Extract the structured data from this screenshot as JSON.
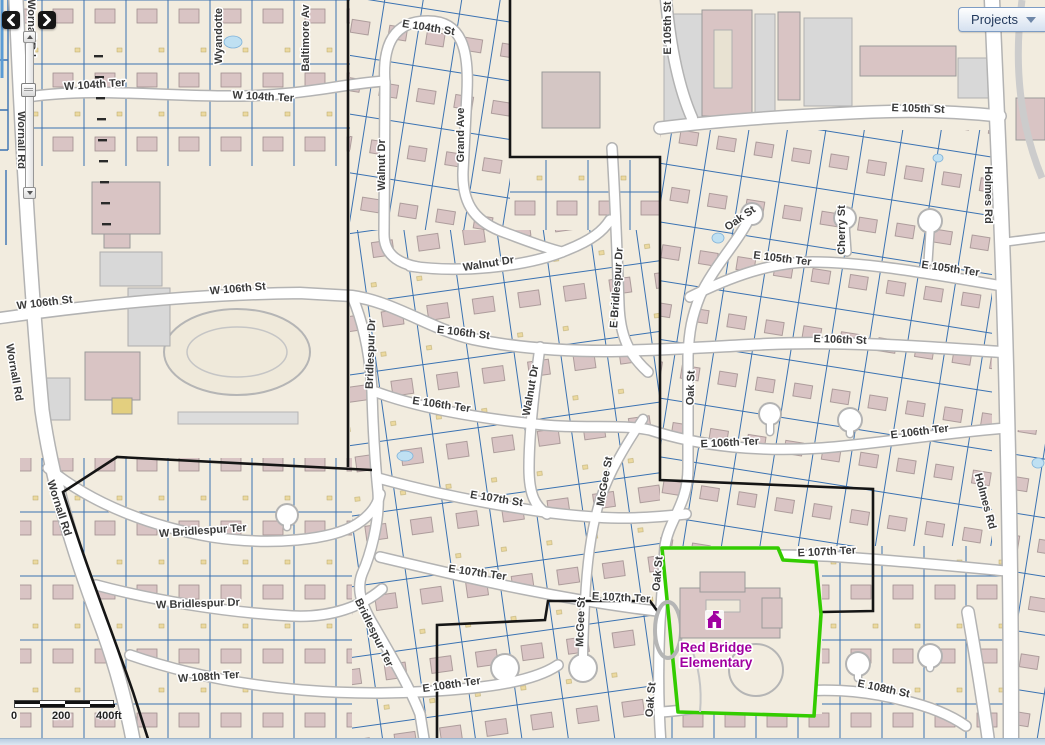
{
  "ui": {
    "nav": {
      "back_icon": "chevron-left",
      "forward_icon": "chevron-right"
    },
    "projects_button": {
      "label": "Projects",
      "caret_icon": "caret-down"
    },
    "scale_bar": {
      "ticks": [
        "0",
        "200",
        "400ft"
      ]
    }
  },
  "map": {
    "poi": {
      "school": {
        "icon": "school-icon",
        "name_lines": [
          "Red Bridge",
          "Elementary"
        ],
        "color": "#A000A0"
      }
    },
    "colors": {
      "background": "#F2ECDF",
      "parcel_line": "#3A72B2",
      "road_fill": "#FFFFFF",
      "road_casing": "#B3B3B3",
      "building": "#D9C4C4",
      "water": "#BFE0F2",
      "boundary_outline": "#151515",
      "selection_outline": "#33CC00",
      "street_label": "#3A3A3A"
    },
    "street_labels": [
      {
        "text": "W 104th Ter",
        "x": 95,
        "y": 88,
        "rot": -4
      },
      {
        "text": "W 104th Ter",
        "x": 263,
        "y": 100,
        "rot": 3
      },
      {
        "text": "E 104th St",
        "x": 428,
        "y": 31,
        "rot": 9
      },
      {
        "text": "Wyandotte",
        "x": 222,
        "y": 36,
        "rot": -90
      },
      {
        "text": "Baltimore Av",
        "x": 309,
        "y": 38,
        "rot": -90
      },
      {
        "text": "Grand Ave",
        "x": 464,
        "y": 135,
        "rot": -90
      },
      {
        "text": "Walnut Dr",
        "x": 385,
        "y": 165,
        "rot": -90
      },
      {
        "text": "E 105th St",
        "x": 671,
        "y": 28,
        "rot": -90
      },
      {
        "text": "E 105th St",
        "x": 918,
        "y": 112,
        "rot": 2
      },
      {
        "text": "E 105th Ter",
        "x": 782,
        "y": 262,
        "rot": 7
      },
      {
        "text": "E 105th Ter",
        "x": 950,
        "y": 272,
        "rot": 8
      },
      {
        "text": "Oak St",
        "x": 742,
        "y": 221,
        "rot": -35
      },
      {
        "text": "Cherry St",
        "x": 845,
        "y": 230,
        "rot": -90
      },
      {
        "text": "Holmes Rd",
        "x": 985,
        "y": 195,
        "rot": 90
      },
      {
        "text": "Holmes Rd",
        "x": 982,
        "y": 502,
        "rot": 75
      },
      {
        "text": "W 106th St",
        "x": 45,
        "y": 306,
        "rot": -7
      },
      {
        "text": "W 106th St",
        "x": 238,
        "y": 292,
        "rot": -5
      },
      {
        "text": "Wornall Rd",
        "x": 28,
        "y": 28,
        "rot": 90
      },
      {
        "text": "Wornall Rd",
        "x": 18,
        "y": 140,
        "rot": 90
      },
      {
        "text": "Wornall Rd",
        "x": 11,
        "y": 373,
        "rot": 80
      },
      {
        "text": "Wornall Rd",
        "x": 56,
        "y": 509,
        "rot": 72
      },
      {
        "text": "Walnut Dr",
        "x": 489,
        "y": 267,
        "rot": -9
      },
      {
        "text": "Walnut Dr",
        "x": 534,
        "y": 391,
        "rot": -80
      },
      {
        "text": "E Bridlespur Dr",
        "x": 620,
        "y": 288,
        "rot": -86
      },
      {
        "text": "Bridlespur Dr",
        "x": 374,
        "y": 354,
        "rot": -88
      },
      {
        "text": "E 106th St",
        "x": 463,
        "y": 336,
        "rot": 7
      },
      {
        "text": "E 106th St",
        "x": 840,
        "y": 343,
        "rot": 2
      },
      {
        "text": "E 106th Ter",
        "x": 441,
        "y": 408,
        "rot": 8
      },
      {
        "text": "E 106th Ter",
        "x": 730,
        "y": 446,
        "rot": -3
      },
      {
        "text": "E 106th Ter",
        "x": 920,
        "y": 435,
        "rot": -7
      },
      {
        "text": "McGee St",
        "x": 608,
        "y": 482,
        "rot": -80
      },
      {
        "text": "McGee St",
        "x": 584,
        "y": 622,
        "rot": -88
      },
      {
        "text": "E 107th St",
        "x": 496,
        "y": 502,
        "rot": 9
      },
      {
        "text": "E 107th Ter",
        "x": 477,
        "y": 576,
        "rot": 8
      },
      {
        "text": "E 107th Ter",
        "x": 621,
        "y": 601,
        "rot": 3
      },
      {
        "text": "E 107th Ter",
        "x": 827,
        "y": 555,
        "rot": -3
      },
      {
        "text": "Oak St",
        "x": 694,
        "y": 388,
        "rot": -88
      },
      {
        "text": "Oak St",
        "x": 661,
        "y": 574,
        "rot": -85
      },
      {
        "text": "Oak St",
        "x": 654,
        "y": 700,
        "rot": -85
      },
      {
        "text": "W Bridlespur Ter",
        "x": 203,
        "y": 534,
        "rot": -4
      },
      {
        "text": "W Bridlespur Dr",
        "x": 198,
        "y": 607,
        "rot": -2
      },
      {
        "text": "Bridlespur Ter",
        "x": 371,
        "y": 634,
        "rot": 64
      },
      {
        "text": "W 108th Ter",
        "x": 209,
        "y": 680,
        "rot": -4
      },
      {
        "text": "E 108th Ter",
        "x": 452,
        "y": 688,
        "rot": -8
      },
      {
        "text": "E 108th St",
        "x": 883,
        "y": 692,
        "rot": 12
      }
    ]
  }
}
